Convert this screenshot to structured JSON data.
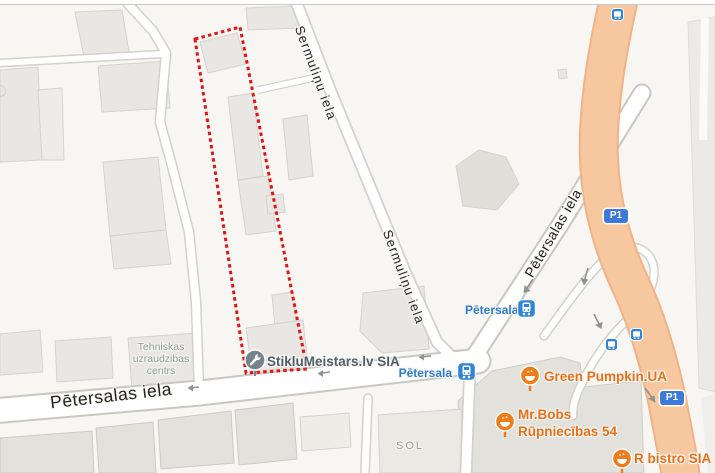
{
  "streets": {
    "sermulinu_upper": "Sermuliņu iela",
    "sermulinu_mid": "Sermuliņu iela",
    "petersalas_diagonal": "Pētersalas iela",
    "petersalas_main": "Pētersalas iela"
  },
  "areas": {
    "tehniskas_line1": "Tehniskas",
    "tehniskas_line2": "uzraudzibas",
    "tehniskas_line3": "centrs",
    "sol": "SOL"
  },
  "transit": {
    "stop1": "Pētersala",
    "stop2": "Pētersala"
  },
  "route_badges": {
    "p1_upper": "P1",
    "p1_lower": "P1"
  },
  "pois": {
    "glazier": "StikluMeistars.lv SIA",
    "green_pumpkin": "Green Pumpkin.UA",
    "mr_bobs_line1": "Mr.Bobs",
    "mr_bobs_line2": "Rūpniecības 54",
    "r_bistro": "R bistro SIA"
  },
  "icons": {
    "glazier_poi": "wrench-pin-icon",
    "food_poi": "food-bowl-pin-icon",
    "transit_stop": "tram-icon",
    "bus_stop": "bus-icon"
  },
  "colors": {
    "selection_red": "#e41414",
    "highway_orange": "#f7c79f",
    "highway_casing": "#f0b286",
    "transit_blue": "#2e86d6",
    "transit_text_blue": "#2d7dd2",
    "poi_orange": "#ef7c1a",
    "poi_orange_text": "#e8701a",
    "poi_gray": "#76838e",
    "building_gray": "#e8e7e3",
    "map_background": "#f7f6f3"
  }
}
